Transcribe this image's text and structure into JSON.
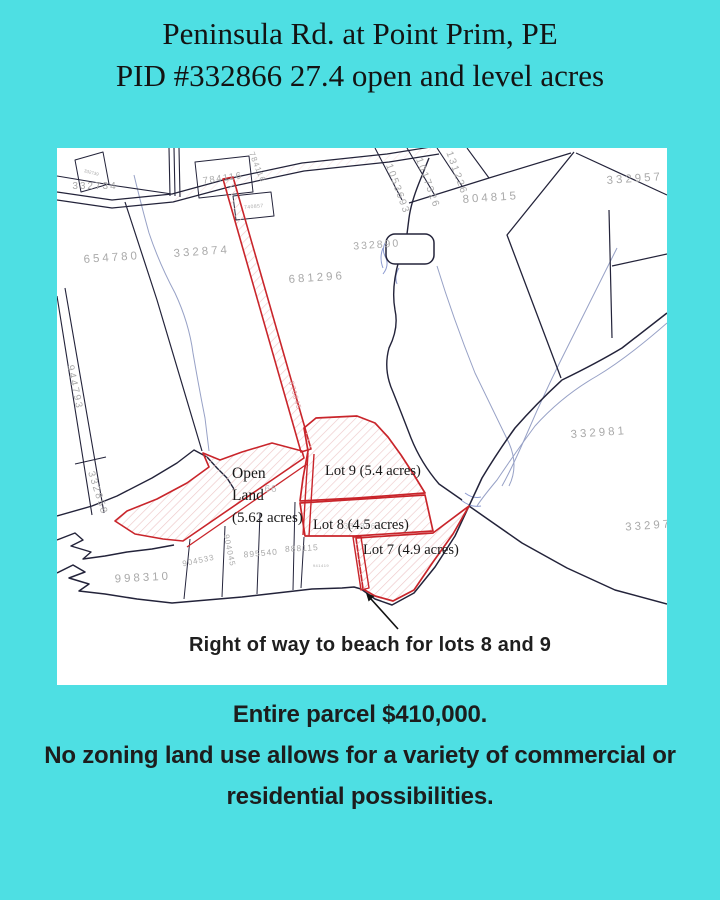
{
  "header": {
    "line1": "Peninsula Rd. at Point Prim, PE",
    "line2": "PID #332866 27.4 open and level acres"
  },
  "map": {
    "annotation": "Right of way to beach for lots 8 and 9",
    "lot_labels": [
      "Open",
      "Land",
      "(5.62 acres)",
      "Lot 9 (5.4 acres)",
      "Lot 8 (4.5 acres)",
      "Lot 7 (4.9 acres)"
    ],
    "parcel_ids": [
      "332734",
      "332739",
      "784116",
      "784116",
      "740857",
      "654780",
      "332874",
      "681296",
      "1053693",
      "1017326",
      "131226",
      "804815",
      "332957",
      "332890",
      "944793",
      "332858",
      "332981",
      "33297",
      "998310",
      "904533",
      "904045",
      "895540",
      "888115",
      "941419",
      "66",
      "332866",
      "870645"
    ]
  },
  "footer": {
    "price": "Entire parcel $410,000.",
    "description_line1": "No zoning land use allows for a variety of commercial or",
    "description_line2": "residential possibilities."
  },
  "colors": {
    "background": "#4edfe3",
    "map_background": "#ffffff",
    "boundary": "#23233a",
    "water": "#97a1c6",
    "marsh": "#8c9ad0",
    "red": "#c9252b",
    "hatch": "#eec9ca",
    "parcel_label": "#a9a9a9",
    "ink": "#1c1c1c"
  }
}
